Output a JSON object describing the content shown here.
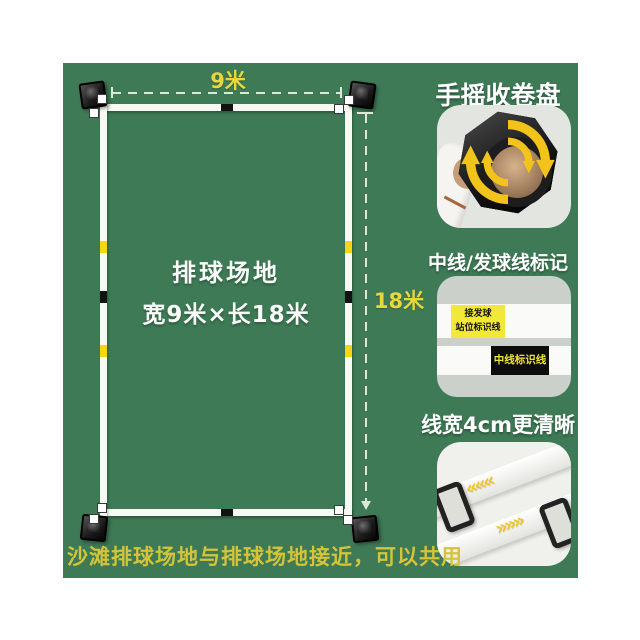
{
  "product": {
    "court": {
      "name": "排球场地",
      "dimensions": "宽9米×长18米",
      "width_label": "9米",
      "length_label": "18米"
    },
    "features": {
      "reel_title": "手摇收卷盘",
      "marker_title": "中线/发球线标记",
      "serve_line_label_line1": "接发球",
      "serve_line_label_line2": "站位标识线",
      "center_line_label": "中线标识线",
      "width_title": "线宽4cm更清晰"
    },
    "caption": "沙滩排球场地与排球场地接近，可以共用"
  },
  "icons": {
    "chevrons_left": "«««",
    "chevrons_right": "»»»"
  },
  "colors": {
    "canvas_green": "#3d7a55",
    "accent_yellow": "#e9d63f",
    "court_line_white": "#f7f9f3",
    "marker_yellow": "#f2d713",
    "marker_black": "#121212",
    "caption_yellow": "#d5c43a",
    "reel_arrow_yellow": "#f2c31b"
  }
}
